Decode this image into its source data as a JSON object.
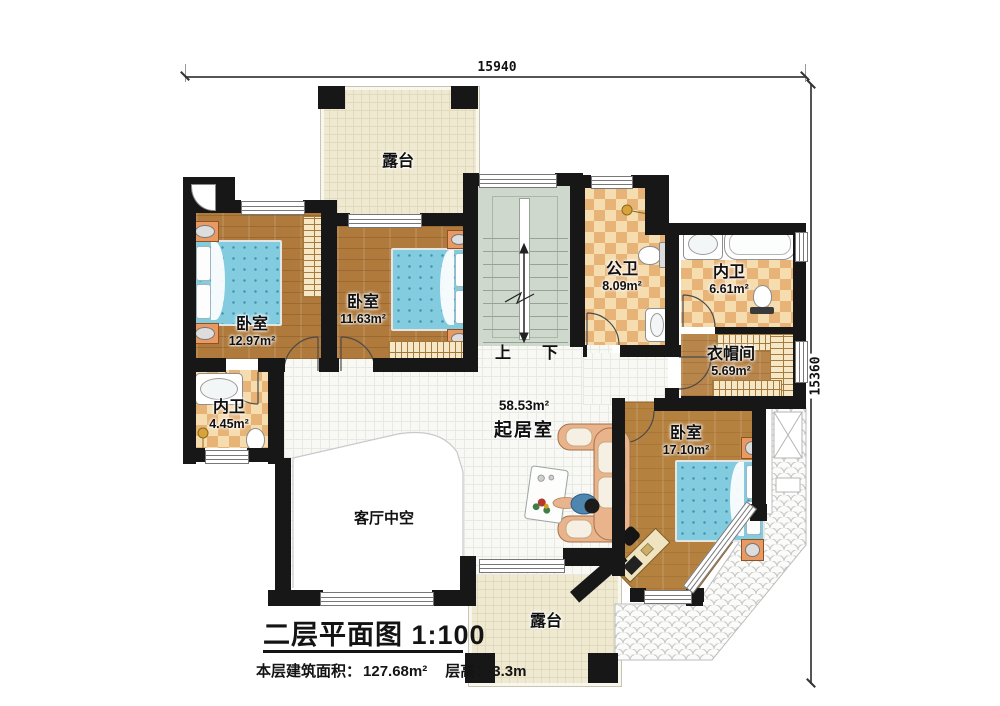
{
  "dimensions": {
    "top": "15940",
    "right": "15360"
  },
  "rooms": [
    {
      "id": "terrace-top",
      "name": "露台",
      "area": ""
    },
    {
      "id": "bedroom-left",
      "name": "卧室",
      "area": "12.97m²"
    },
    {
      "id": "bedroom-mid",
      "name": "卧室",
      "area": "11.63m²"
    },
    {
      "id": "bath-public",
      "name": "公卫",
      "area": "8.09m²"
    },
    {
      "id": "bath-inner-right",
      "name": "内卫",
      "area": "6.61m²"
    },
    {
      "id": "cloakroom",
      "name": "衣帽间",
      "area": "5.69m²"
    },
    {
      "id": "bath-inner-left",
      "name": "内卫",
      "area": "4.45m²"
    },
    {
      "id": "living-room",
      "name": "起居室",
      "area": "58.53m²"
    },
    {
      "id": "bedroom-right",
      "name": "卧室",
      "area": "17.10m²"
    },
    {
      "id": "void-over-living",
      "name": "客厅中空",
      "area": ""
    },
    {
      "id": "terrace-bottom",
      "name": "露台",
      "area": ""
    }
  ],
  "stairs": {
    "up": "上",
    "down": "下"
  },
  "title_block": {
    "title": "二层平面图 1:100",
    "area_label": "本层建筑面积：",
    "area_value": "127.68m²",
    "height_label": "层高：",
    "height_value": "3.3m"
  }
}
